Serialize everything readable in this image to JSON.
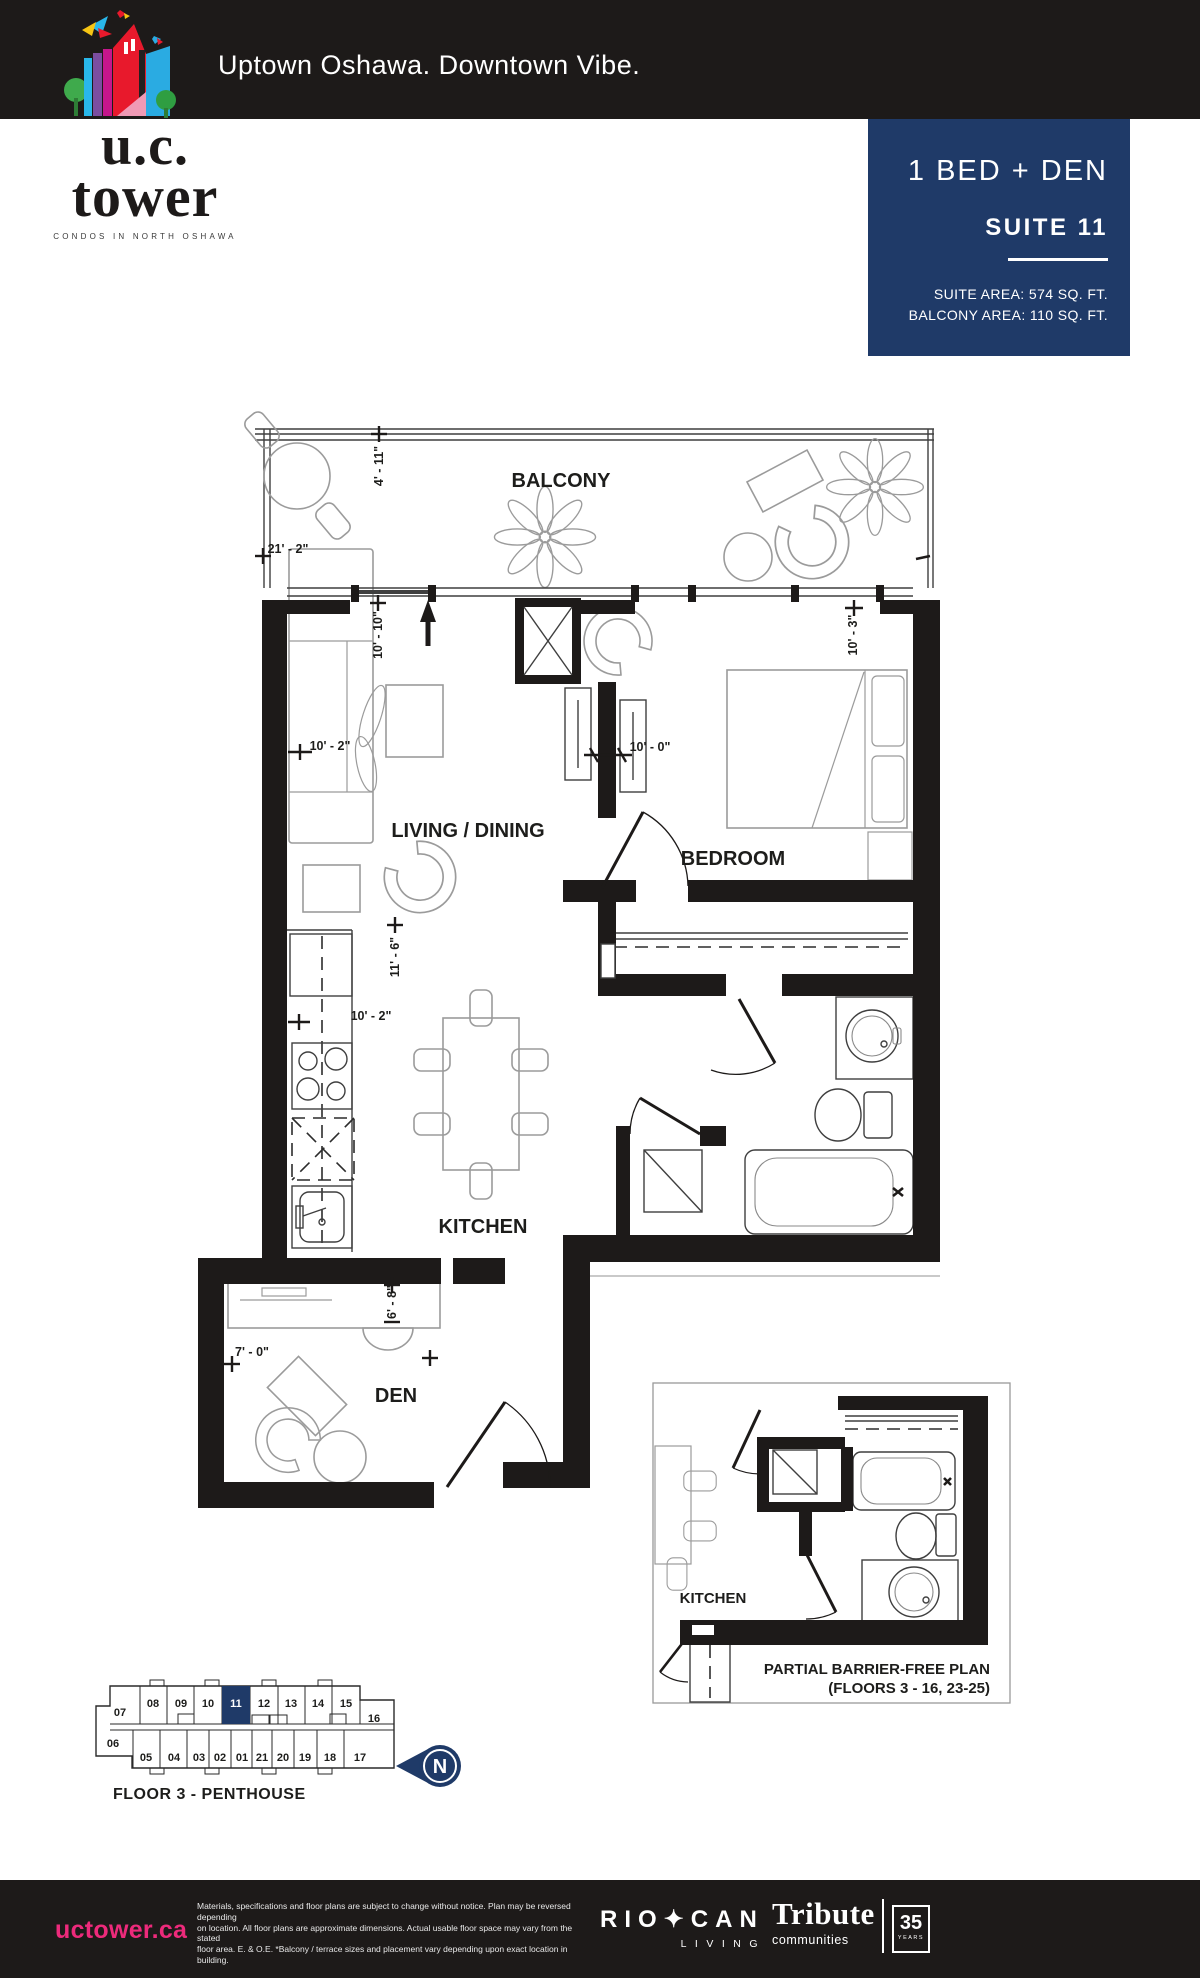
{
  "header": {
    "tagline": "Uptown Oshawa. Downtown Vibe.",
    "logo": {
      "line1": "u.c.",
      "line2": "tower",
      "subtitle": "CONDOS IN NORTH OSHAWA"
    }
  },
  "suite": {
    "type": "1 BED + DEN",
    "name": "SUITE 11",
    "area_line1": "SUITE AREA: 574 SQ. FT.",
    "area_line2": "BALCONY AREA: 110 SQ. FT.",
    "accent_color": "#1f3a68"
  },
  "plan": {
    "labels": {
      "balcony": "BALCONY",
      "living": "LIVING / DINING",
      "bedroom": "BEDROOM",
      "kitchen": "KITCHEN",
      "den": "DEN"
    },
    "dims": {
      "balcony_depth": "4' - 11\"",
      "balcony_width": "21' - 2\"",
      "living_depth": "10' - 10\"",
      "living_width": "10' - 2\"",
      "hall_width": "10' - 0\"",
      "bedroom_width": "10' - 3\"",
      "kitchen_length": "11' - 6\"",
      "kitchen_width": "10' - 2\"",
      "den_depth": "6' - 8\"",
      "den_width": "7' - 0\""
    }
  },
  "partial": {
    "kitchen_label": "KITCHEN",
    "title_line1": "PARTIAL BARRIER-FREE PLAN",
    "title_line2": "(FLOORS 3 - 16, 23-25)"
  },
  "keyplan": {
    "floor_label": "FLOOR 3 - PENTHOUSE",
    "north_label": "N",
    "top_row": [
      "07",
      "08",
      "09",
      "10",
      "11",
      "12",
      "13",
      "14",
      "15",
      "16"
    ],
    "bottom_row": [
      "06",
      "05",
      "04",
      "03",
      "02",
      "01",
      "21",
      "20",
      "19",
      "18",
      "17"
    ]
  },
  "footer": {
    "website": "uctower.ca",
    "disclaimer": [
      "Materials, specifications and floor plans are subject to change without notice. Plan may be reversed depending",
      "on location. All floor plans are approximate dimensions. Actual usable floor space may vary from the stated",
      "floor area. E. & O.E. *Balcony / terrace sizes and placement vary depending upon exact location in building."
    ],
    "riocan_name": "RIO✦CAN",
    "riocan_sub": "LIVING",
    "tribute_name": "Tribute",
    "tribute_sub": "communities",
    "years": "35",
    "years_label": "YEARS"
  }
}
